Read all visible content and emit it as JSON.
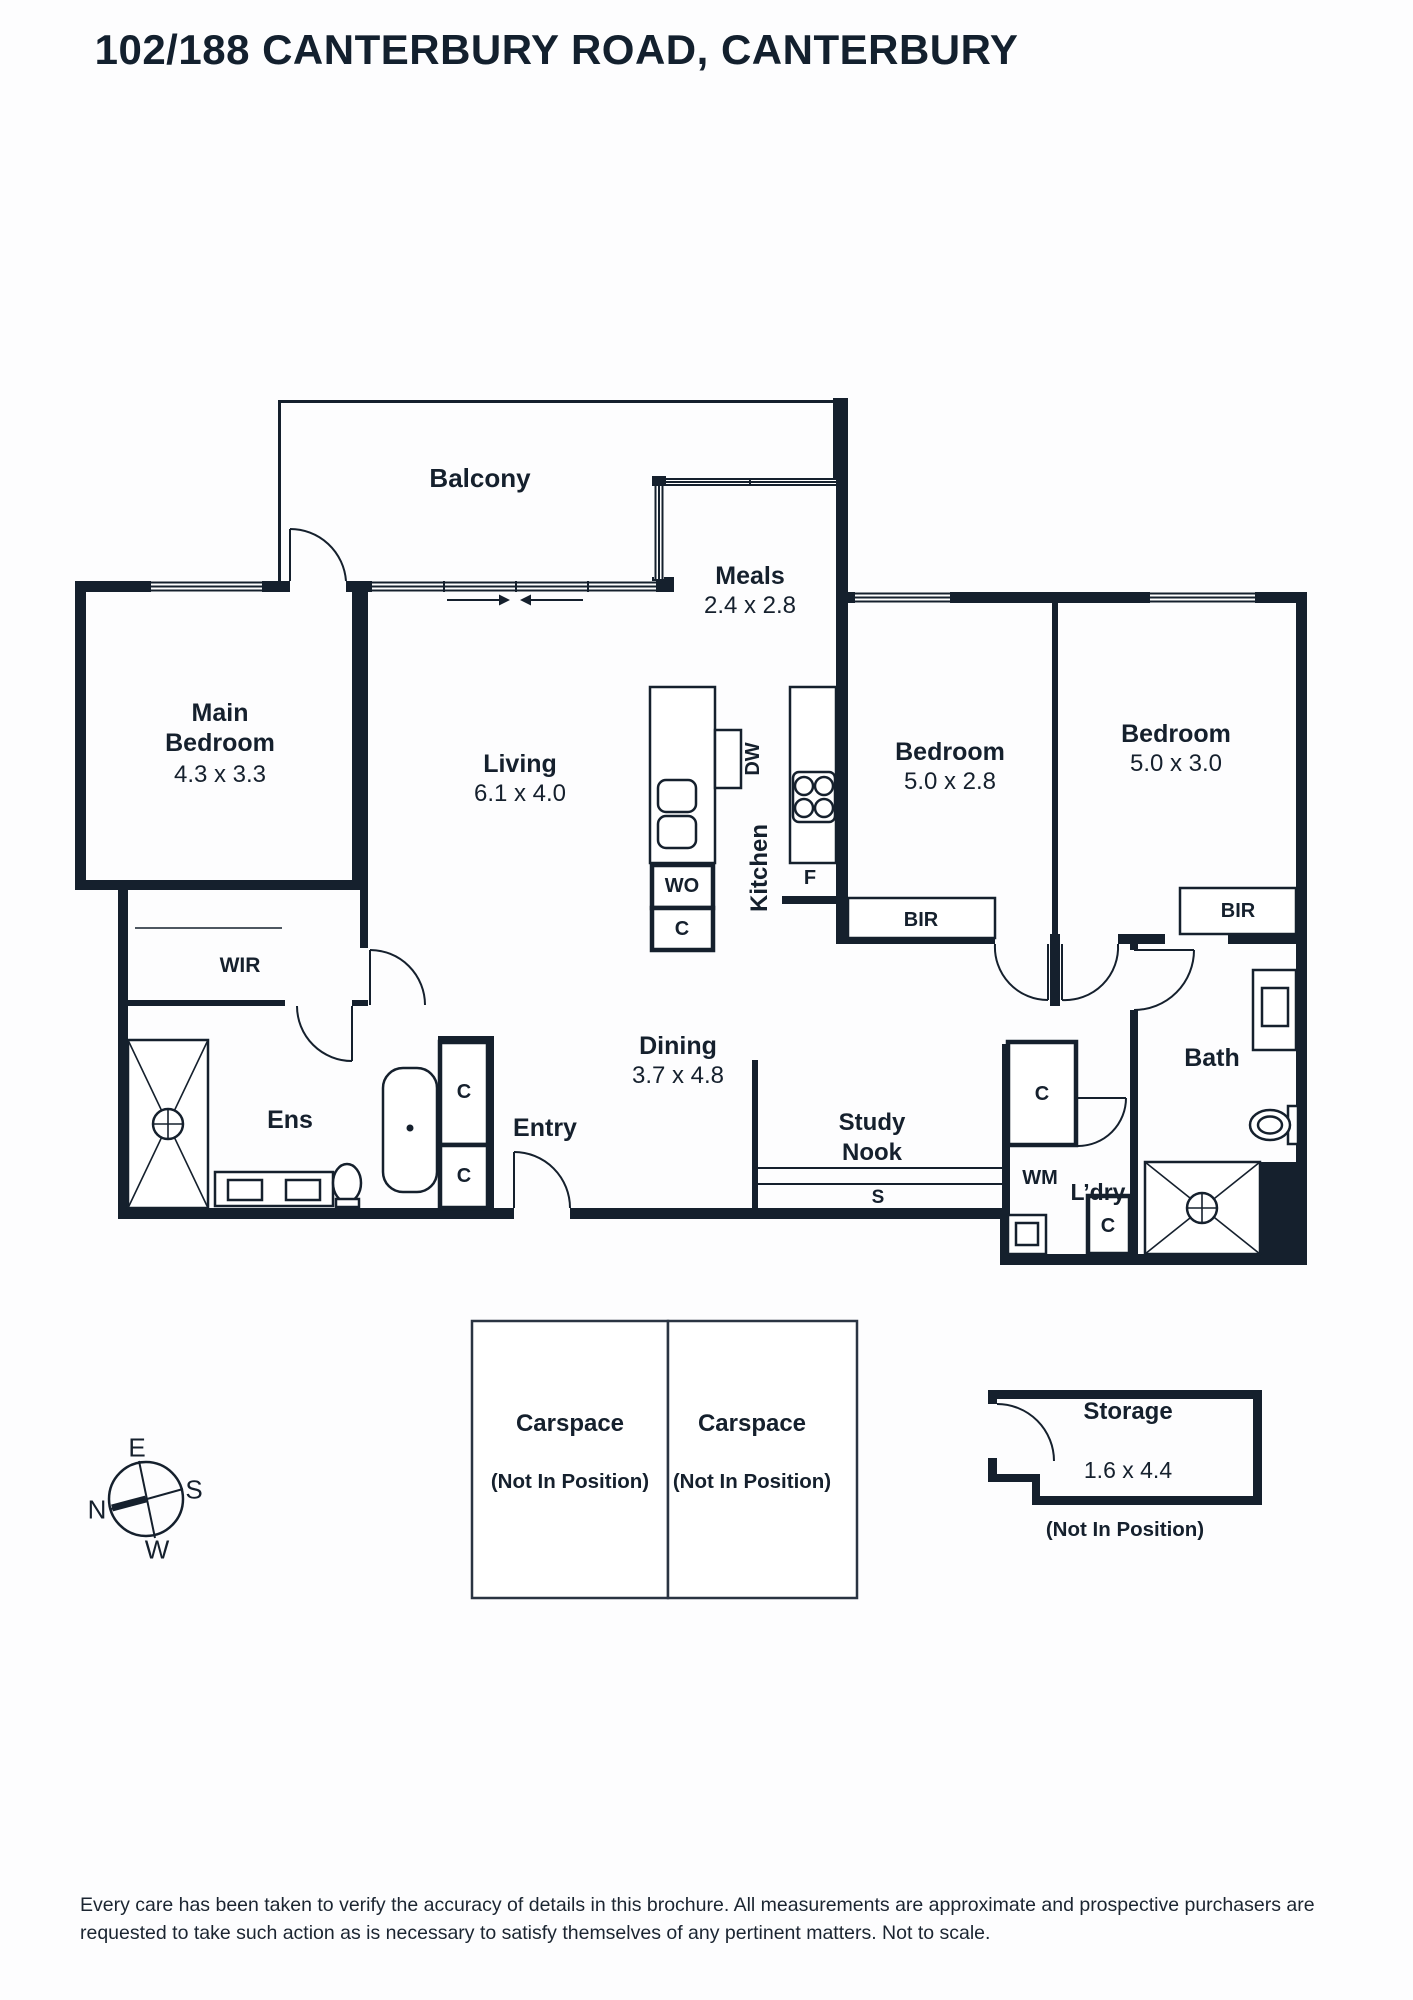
{
  "title": "102/188 CANTERBURY ROAD, CANTERBURY",
  "colors": {
    "ink": "#15202d",
    "background": "#ffffff"
  },
  "rooms": {
    "balcony": {
      "name": "Balcony"
    },
    "meals": {
      "name": "Meals",
      "dims": "2.4 x 2.8"
    },
    "main_bedroom": {
      "name": "Main\nBedroom",
      "dims": "4.3 x 3.3"
    },
    "living": {
      "name": "Living",
      "dims": "6.1 x 4.0"
    },
    "kitchen": {
      "name": "Kitchen"
    },
    "bedroom1": {
      "name": "Bedroom",
      "dims": "5.0 x 2.8"
    },
    "bedroom2": {
      "name": "Bedroom",
      "dims": "5.0 x 3.0"
    },
    "dining": {
      "name": "Dining",
      "dims": "3.7 x 4.8"
    },
    "study_nook": {
      "name": "Study\nNook"
    },
    "entry": {
      "name": "Entry"
    },
    "wir": {
      "name": "WIR"
    },
    "ens": {
      "name": "Ens"
    },
    "bath": {
      "name": "Bath"
    },
    "laundry": {
      "name": "L’dry"
    }
  },
  "fixtures": {
    "dw": "DW",
    "wo": "WO",
    "c": "C",
    "f": "F",
    "wm": "WM",
    "s": "S",
    "bir": "BIR"
  },
  "outbuildings": {
    "carspace1": {
      "name": "Carspace",
      "note": "(Not In Position)"
    },
    "carspace2": {
      "name": "Carspace",
      "note": "(Not In Position)"
    },
    "storage": {
      "name": "Storage",
      "dims": "1.6 x 4.4",
      "note": "(Not In Position)"
    }
  },
  "compass": {
    "n": "N",
    "e": "E",
    "s": "S",
    "w": "W"
  },
  "disclaimer": "Every care has been taken to verify the accuracy of details in this brochure. All measurements are approximate and prospective purchasers are requested to take such action as is necessary to satisfy themselves of any pertinent matters. Not to scale."
}
